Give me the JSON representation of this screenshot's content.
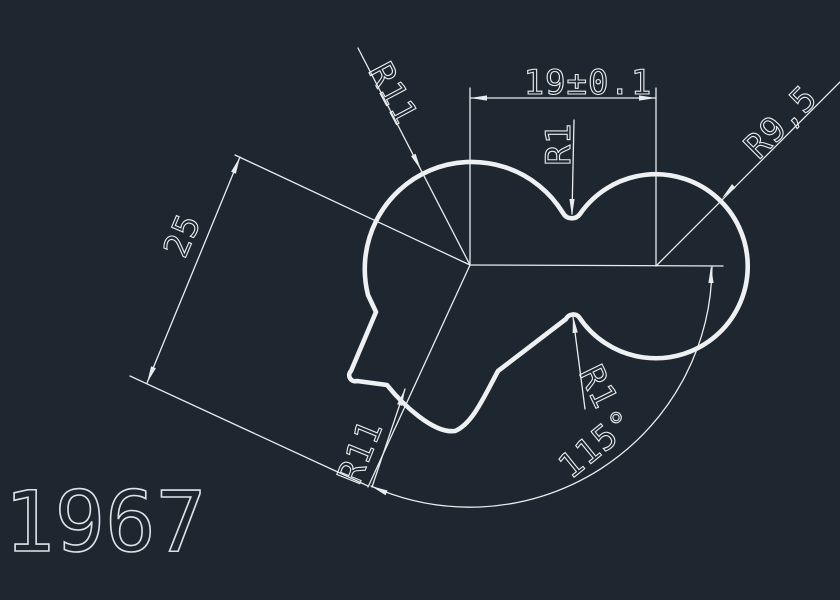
{
  "canvas": {
    "background_color": "#1e2630",
    "line_color": "#e8ecef",
    "profile_color": "#eef1f4",
    "part_number": "1967"
  },
  "labels": {
    "width_dim": "19±0.1",
    "top_left_radius": "R11",
    "top_notch_radius": "R1",
    "right_lobe_radius": "R9,5",
    "height_dim": "25",
    "bottom_notch_radius": "R1",
    "bottom_cut_radius": "R11",
    "angle_dim": "115°"
  }
}
